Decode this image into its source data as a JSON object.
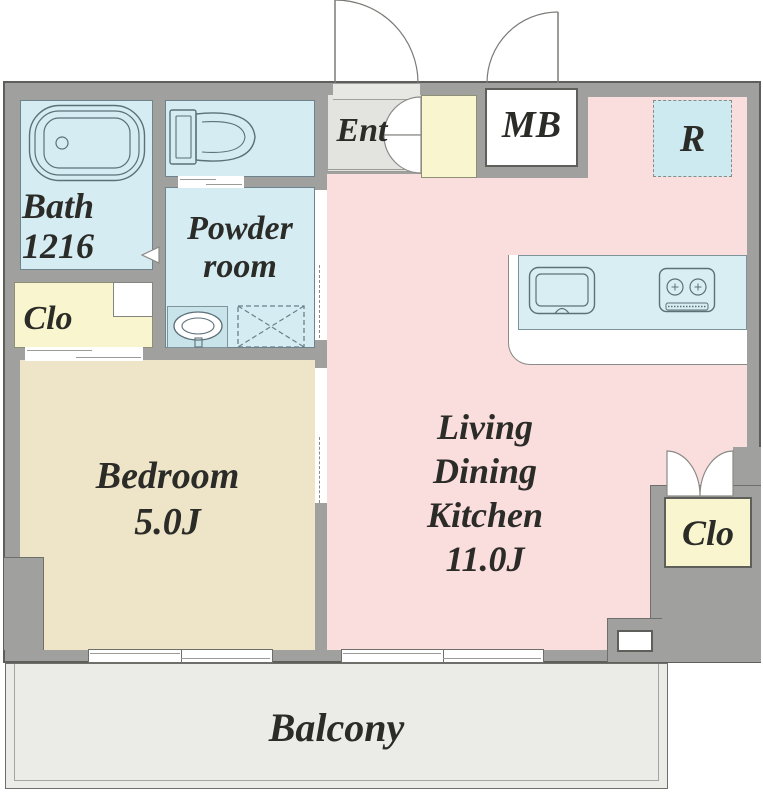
{
  "title": "1LDK apartment floor plan",
  "colors": {
    "wall": "#a0a09e",
    "wall_dark": "#5e5e5a",
    "wet_blue": "#d5ecf2",
    "counter_blue": "#d9eef3",
    "fridge_blue": "#cdeaf1",
    "pink": "#fadddd",
    "beige": "#eee5c9",
    "yellow": "#f9f6cf",
    "ent_gray": "#e3e3df",
    "balcony_gray": "#ebebe7",
    "icon_stroke": "#5c7078",
    "door_stroke": "#8a8a86",
    "text": "#2b2b28"
  },
  "rooms": {
    "bath": {
      "lines": [
        "Bath",
        "1216"
      ]
    },
    "powder": {
      "lines": [
        "Powder",
        "room"
      ]
    },
    "closet_left": {
      "label": "Clo"
    },
    "bedroom": {
      "lines": [
        "Bedroom",
        "5.0J"
      ]
    },
    "entrance": {
      "label": "Ent"
    },
    "meter_box": {
      "label": "MB"
    },
    "refrigerator": {
      "label": "R"
    },
    "ldk": {
      "lines": [
        "Living",
        "Dining",
        "Kitchen",
        "11.0J"
      ]
    },
    "closet_right": {
      "label": "Clo"
    },
    "balcony": {
      "label": "Balcony"
    }
  }
}
